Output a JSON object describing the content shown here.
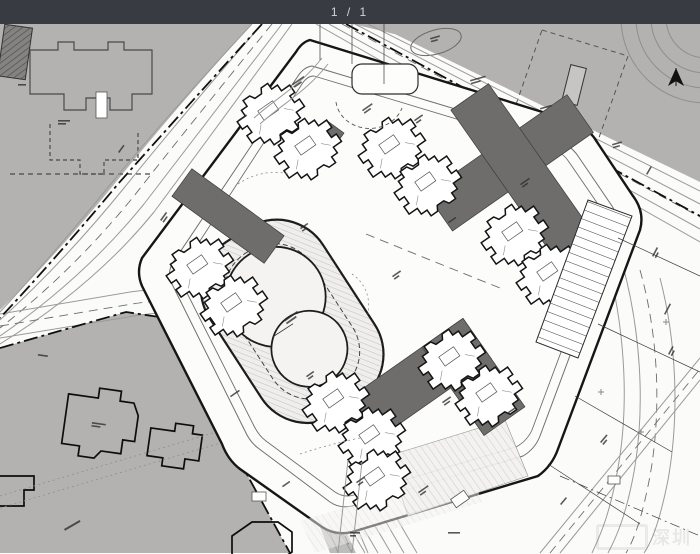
{
  "viewer": {
    "page_indicator": "1 / 1"
  },
  "theme": {
    "topbar_bg": "#383c42",
    "topbar_text": "#d2d4d7",
    "paper": "#fbfbfa",
    "parcel_gray": "#b3b2b1",
    "dark_building": "#6e6d6c",
    "ink": "#1a1a1a",
    "hatch_line": "#cbc9c7"
  },
  "watermark": {
    "text": "深圳"
  }
}
